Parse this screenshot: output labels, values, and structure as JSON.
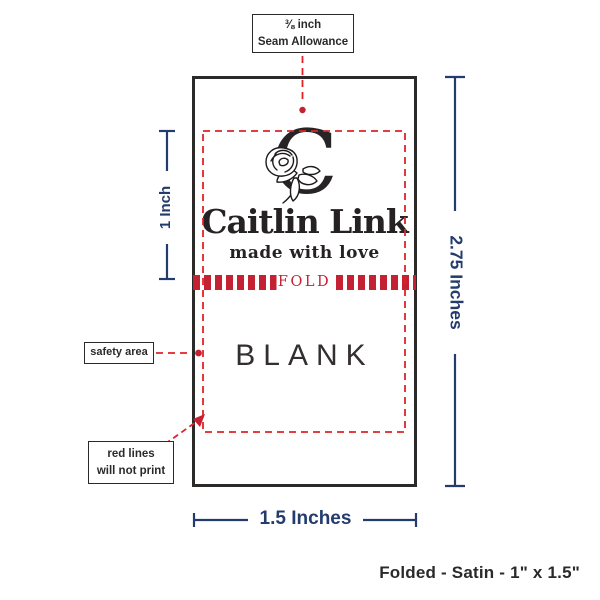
{
  "label": {
    "monogram": "C",
    "brand": "Caitlin Link",
    "tagline": "made with love",
    "fold_label": "FOLD",
    "blank_label": "BLANK"
  },
  "annotations": {
    "seam_allowance": {
      "line1": "⅜ inch",
      "line2": "Seam Allowance"
    },
    "safety_area": {
      "label": "safety area"
    },
    "red_lines": {
      "line1": "red lines",
      "line2": "will not print"
    }
  },
  "dimensions": {
    "fold_height": "1 Inch",
    "total_height": "2.75 Inches",
    "width": "1.5 Inches"
  },
  "caption": "Folded - Satin - 1\" x 1.5\"",
  "colors": {
    "navy": "#233c6d",
    "guide_red": "#e02327",
    "fold_red": "#c42133",
    "ink": "#2b2a29"
  }
}
